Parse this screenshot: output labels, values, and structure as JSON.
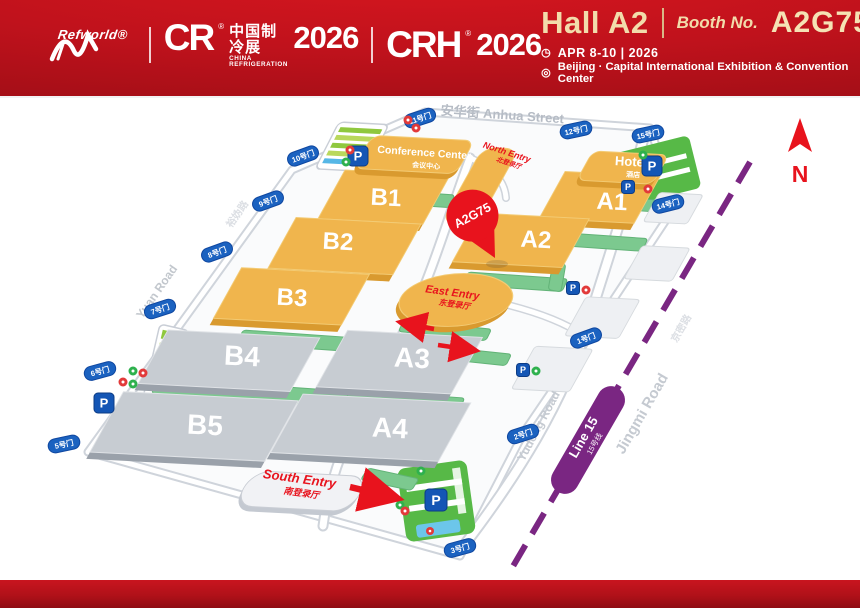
{
  "header": {
    "brand": {
      "refworld": "Refworld®",
      "cr": "CR",
      "reg": "®",
      "cr_cn": "中国制冷展",
      "cr_en": "CHINA REFRIGERATION",
      "year_left": "2026",
      "crh": "CRH",
      "year_right": "2026"
    },
    "hall": "Hall A2",
    "booth_label": "Booth No.",
    "booth_no": "A2G75",
    "clock_icon": "◷",
    "loc_icon": "◎",
    "date": "APR 8-10 | 2026",
    "venue": "Beijing · Capital International Exhibition & Convention Center"
  },
  "map": {
    "halls": {
      "b1": "B1",
      "b2": "B2",
      "b3": "B3",
      "b4": "B4",
      "b5": "B5",
      "a1": "A1",
      "a2": "A2",
      "a3": "A3",
      "a4": "A4"
    },
    "buildings": {
      "conference_en": "Conference Center",
      "conference_cn": "会议中心",
      "hotel_en": "Hotel",
      "hotel_cn": "酒店"
    },
    "entries": {
      "north_en": "North Entry",
      "north_cn": "北登录厅",
      "east_en": "East Entry",
      "east_cn": "东登录厅",
      "south_en": "South Entry",
      "south_cn": "南登录厅"
    },
    "pin_label": "A2G75",
    "roads": {
      "anhua": "安华街 Anhua Street",
      "yuan": "Yuan Road",
      "yudong": "Yudong Road",
      "jingmi": "Jingmi Road",
      "jingmi_cn": "京密路",
      "west_cn": "裕妫路"
    },
    "metro": {
      "line_en": "Line 15",
      "line_cn": "15号线"
    },
    "compass": "N",
    "parking_label": "P",
    "gates": [
      "11号门",
      "12号门",
      "15号门",
      "14号门",
      "10号门",
      "9号门",
      "8号门",
      "7号门",
      "6号门",
      "5号门",
      "1号门",
      "2号门",
      "3号门"
    ]
  },
  "colors": {
    "header_red": "#c0121c",
    "accent_red": "#e8131d",
    "hall_orange": "#f0b54d",
    "hall_gray": "#c7ccd2",
    "strip_green": "#7cc98f",
    "metro_purple": "#7a2682",
    "gate_blue": "#1b62c0",
    "parking_blue": "#1456b5"
  }
}
